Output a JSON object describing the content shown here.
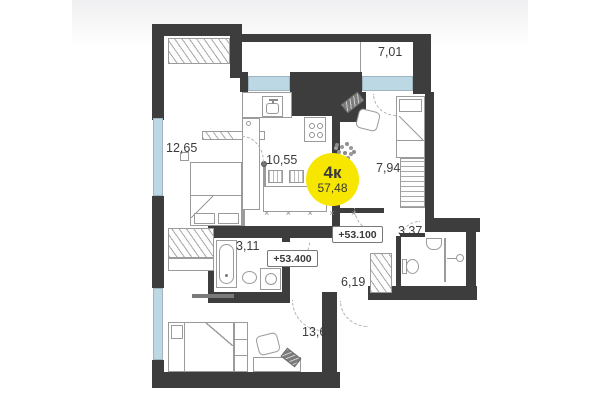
{
  "plan": {
    "badge": {
      "type_label": "4к",
      "area": "57,48"
    },
    "rooms": [
      {
        "name": "loggia",
        "area_label": "7,01"
      },
      {
        "name": "bedroom-left",
        "area_label": "12,65"
      },
      {
        "name": "kitchen-living",
        "area_label": "10,55"
      },
      {
        "name": "bedroom-right",
        "area_label": "7,94"
      },
      {
        "name": "bathroom-small",
        "area_label": "3,37"
      },
      {
        "name": "bathroom-main",
        "area_label": "3,11"
      },
      {
        "name": "hallway",
        "area_label": "6,19"
      },
      {
        "name": "bedroom-bottom",
        "area_label": "13,67"
      }
    ],
    "elevation_marks": [
      {
        "label": "+53.100"
      },
      {
        "label": "+53.400"
      }
    ],
    "decor": {
      "counter_marks": "× × × × ×"
    },
    "colors": {
      "wall": "#3d3d3d",
      "window_glass": "#bdd8e5",
      "marker_yellow": "#f7e600",
      "text": "#3b3b3b"
    }
  }
}
